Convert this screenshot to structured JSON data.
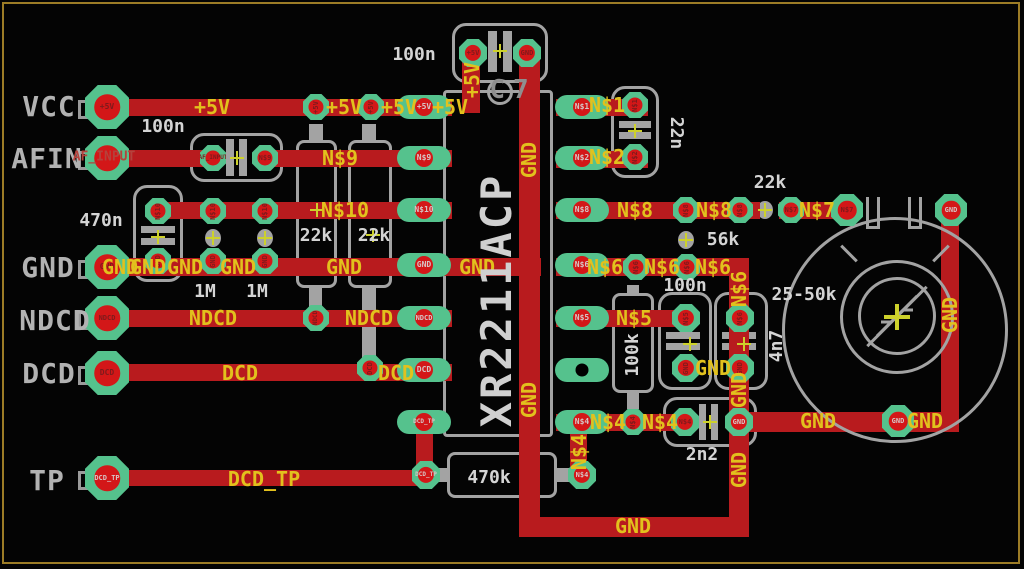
{
  "board": {
    "type": "pcb-layout-editor",
    "background": "#040404",
    "frame_color": "#9c7c26"
  },
  "colors": {
    "trace_red": "#b81b1e",
    "pad_green": "#55c28d",
    "drill_red": "#d31718",
    "net_label_yellow": "#e2c11d",
    "silkscreen_gray": "#a3a3a3",
    "value_text_white": "#d4d4d4",
    "io_text_gray": "#b2b2b2",
    "net_text_red": "#b5423c"
  },
  "io": [
    {
      "name": "VCC"
    },
    {
      "name": "AFIN"
    },
    {
      "name": "GND"
    },
    {
      "name": "NDCD"
    },
    {
      "name": "DCD"
    },
    {
      "name": "TP"
    }
  ],
  "nets": {
    "p5v": "+5V",
    "n1": "N$1",
    "n2": "N$2",
    "n4": "N$4",
    "n5": "N$5",
    "n6": "N$6",
    "n7": "N$7",
    "n8": "N$8",
    "n9": "N$9",
    "n10": "N$10",
    "gnd": "GND",
    "ndcd": "NDCD",
    "dcd": "DCD",
    "dcd_tp": "DCD_TP",
    "af_input": "AF_INPUT"
  },
  "chip": {
    "ref": "C7",
    "part": "XR2211ACP"
  },
  "values": {
    "c_top": "100n",
    "c_af": "100n",
    "c_in": "470n",
    "r_bias": "1M",
    "r_pullup": "22k",
    "c_tank": "22n",
    "r_56k": "56k",
    "r_100k": "100k",
    "c_filt": "100n",
    "c_4n7": "4n7",
    "c_2n2": "2n2",
    "r_470k": "470k",
    "pot_range": "25-50k"
  }
}
